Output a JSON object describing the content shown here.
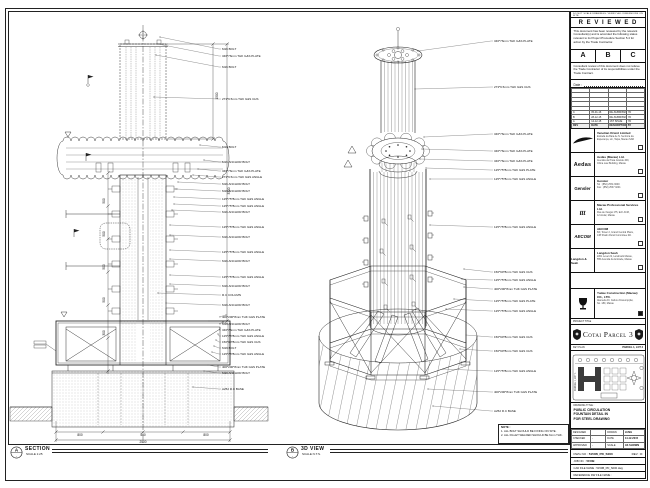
{
  "sheet": {
    "left_view": {
      "tag": "A",
      "title": "SECTION",
      "scale": "SCALE 1:25",
      "annotations": [
        "M16 BOLT",
        "346*76mm THK G&S PLATE",
        "M16 BOLT",
        "273*9.5mm THK G&S CHS",
        "M16 BOLT",
        "M16 ANCHOR BOLT",
        "346*76mm THK G&S PLATE",
        "273*9.5mm THK G&S ANGLE",
        "M16 ANCHOR BOLT",
        "M16 ANCHOR BOLT",
        "125*75*8mm THK G&S ANGLE",
        "125*75*8mm THK G&S ANGLE",
        "M16 ANCHOR BOLT",
        "125*75*8mm THK G&S ANGLE",
        "M16 ANCHOR BOLT",
        "125*75*8mm THK G&S ANGLE",
        "M16 ANCHOR BOLT",
        "125*75*8mm THK G&S ANGLE",
        "M16 ANCHOR BOLT",
        "R.C COLUMN",
        "M16 ANCHOR BOLT",
        "400*200*8mm THK G&S PLATE",
        "M16 ANCHOR BOLT",
        "346*76mm THK G&S PLATE",
        "125*75*8mm THK G&S ANGLE",
        "150*90*8mm THK G&S CHS",
        "M16 BOLT",
        "125*75*8mm THK G&S ANGLE",
        "400*200*8mm THK G&S PLATE",
        "M16 ANCHOR BOLT",
        "A252 R.C BASE"
      ],
      "dims": [
        "500",
        "500",
        "500",
        "500",
        "300",
        "800",
        "500",
        "800",
        "2500",
        "3300",
        "1500"
      ]
    },
    "iso_view": {
      "tag": "B",
      "title": "3D VIEW",
      "scale": "SCALE N.T.S.",
      "annotations": [
        "346*76mm THK G&S PLATE",
        "273*9.5mm THK G&S CHS",
        "346*76mm THK G&S PLATE",
        "346*76mm THK G&S PLATE",
        "346*76mm THK G&S PLATE",
        "125*75*8mm THK G&S PLATE",
        "125*75*8mm THK G&S ANGLE",
        "125*75*8mm THK G&S ANGLE",
        "150*90*8mm THK G&S CHS",
        "125*75*8mm THK G&S ANGLE",
        "400*200*8mm THK G&S PLATE",
        "125*75*8mm THK G&S PLATE",
        "125*75*8mm THK G&S ANGLE",
        "150*90*8mm THK G&S CHS",
        "150*90*8mm THK G&S CHS",
        "125*75*8mm THK G&S ANGLE",
        "400*200*8mm THK G&S PLATE",
        "A252 R.C BASE"
      ]
    },
    "note": {
      "title": "NOTE :",
      "items": [
        "1. ALL BOLT SHOULD BE FIXING ON SITE.",
        "2. ALL FILLET WELDED SHOULD BE 6mm THK."
      ]
    }
  },
  "titleblock": {
    "top_note": "DO NOT SCALE DRAWINGS. VERIFY ALL DIMENSIONS ON SITE.",
    "reviewed": {
      "title": "R E V I E W E D",
      "para1": "This document has been reviewed by the relevant Consultant(s) and is accorded the following status relevant to its Project Procedure Section 5.4 for action by the Trade Contractor.",
      "statuses": [
        "A",
        "B",
        "C"
      ],
      "para2": "Consultant review of this document does not relieve the Trade Contractor of its responsibilities under the Trade Contract.",
      "date_label": "Date :"
    },
    "revisions": {
      "headers": [
        "REV",
        "DATE",
        "DESCRIPTION",
        "BY"
      ],
      "empty_rows": 5,
      "rows": [
        [
          "C",
          "05-01-16",
          "RE-SUBMISSION",
          "YD"
        ],
        [
          "B",
          "28-12-15",
          "RE-SUBMISSION",
          "YD"
        ],
        [
          "A",
          "14-12-15",
          "1ST ISSUE",
          "YD"
        ]
      ]
    },
    "companies": [
      {
        "id": "venetian",
        "logo_text": "Venetian",
        "name": "Venetian Orient Limited",
        "lines": [
          "Estrada da Baía de N. Senhora da",
          "Esperança, s/n, Taipa, Macau SAR"
        ]
      },
      {
        "id": "aedas",
        "logo_text": "Aedas",
        "name": "Aedas (Macau) Ltd.",
        "lines": [
          "Avenida da Praia Grande 409,",
          "China Law Building, Macau"
        ]
      },
      {
        "id": "gensler",
        "logo_text": "Gensler",
        "name": "Gensler",
        "lines": [
          "Tel : (852) 2531 9000",
          "Fax : (852) 2537 0201"
        ]
      },
      {
        "id": "mps",
        "logo_text": "ttt",
        "name": "Macau Professional Services Ltd.",
        "lines": [
          "Rua de Xangai 175, Edf. ACM,",
          "12 Andar, Macau"
        ]
      },
      {
        "id": "aecom",
        "logo_text": "AECOM",
        "name": "AECOM",
        "lines": [
          "8/F, Tower 2, Grand Central Plaza,",
          "138 Shatin Rural Committee Rd."
        ]
      },
      {
        "id": "langdonseah",
        "logo_text": "Langdon & Seah",
        "name": "Langdon Seah",
        "lines": [
          "2201 Level 22, Landmark Macau,",
          "555 Avenida da Amizade, Macau"
        ]
      }
    ],
    "contractor": {
      "name": "Yudee Construction (Macau) CO., LTD.",
      "lines": [
        "Alameda Dr. Carlos d'Assumpção,",
        "No. 180, Macau"
      ]
    },
    "project": {
      "label": "PROJECT TITLE",
      "name": "Cotai Parcel 3"
    },
    "keyplan": {
      "label": "KEY PLAN",
      "parcel_top": "PARCEL 1, LOT 2",
      "parcel_left": "PARCEL 1, LOT 1"
    },
    "drawing": {
      "label": "DRAWING TITLE :",
      "title_lines": [
        "PUBLIC CIRCULATION",
        "FOUNTAIN DETAIL IN",
        "FOR STEEL DRAWING"
      ],
      "designed_label": "DESIGNED",
      "designed": "",
      "drawn_label": "DRAWN",
      "drawn": "LUNG",
      "checked_label": "CHECKED",
      "checked": "-",
      "date_label": "DATE",
      "date": "14-12-2015",
      "approved_label": "APPROVED",
      "approved": "-",
      "scale_label": "SCALE",
      "scale": "AS SHOWN",
      "dwg_no_label": "DWG NO :",
      "dwg_no": "5150B_PD_S000",
      "rev_label": "REV :",
      "rev": "C",
      "job_label": "JOB NO. :",
      "job": "5150B",
      "cad_label": "CAD FILE NAME :",
      "cad": "5150B_PD_S000.dwg",
      "ref_label": "REFERENCE DW FILE NAME :",
      "ref": ""
    }
  }
}
